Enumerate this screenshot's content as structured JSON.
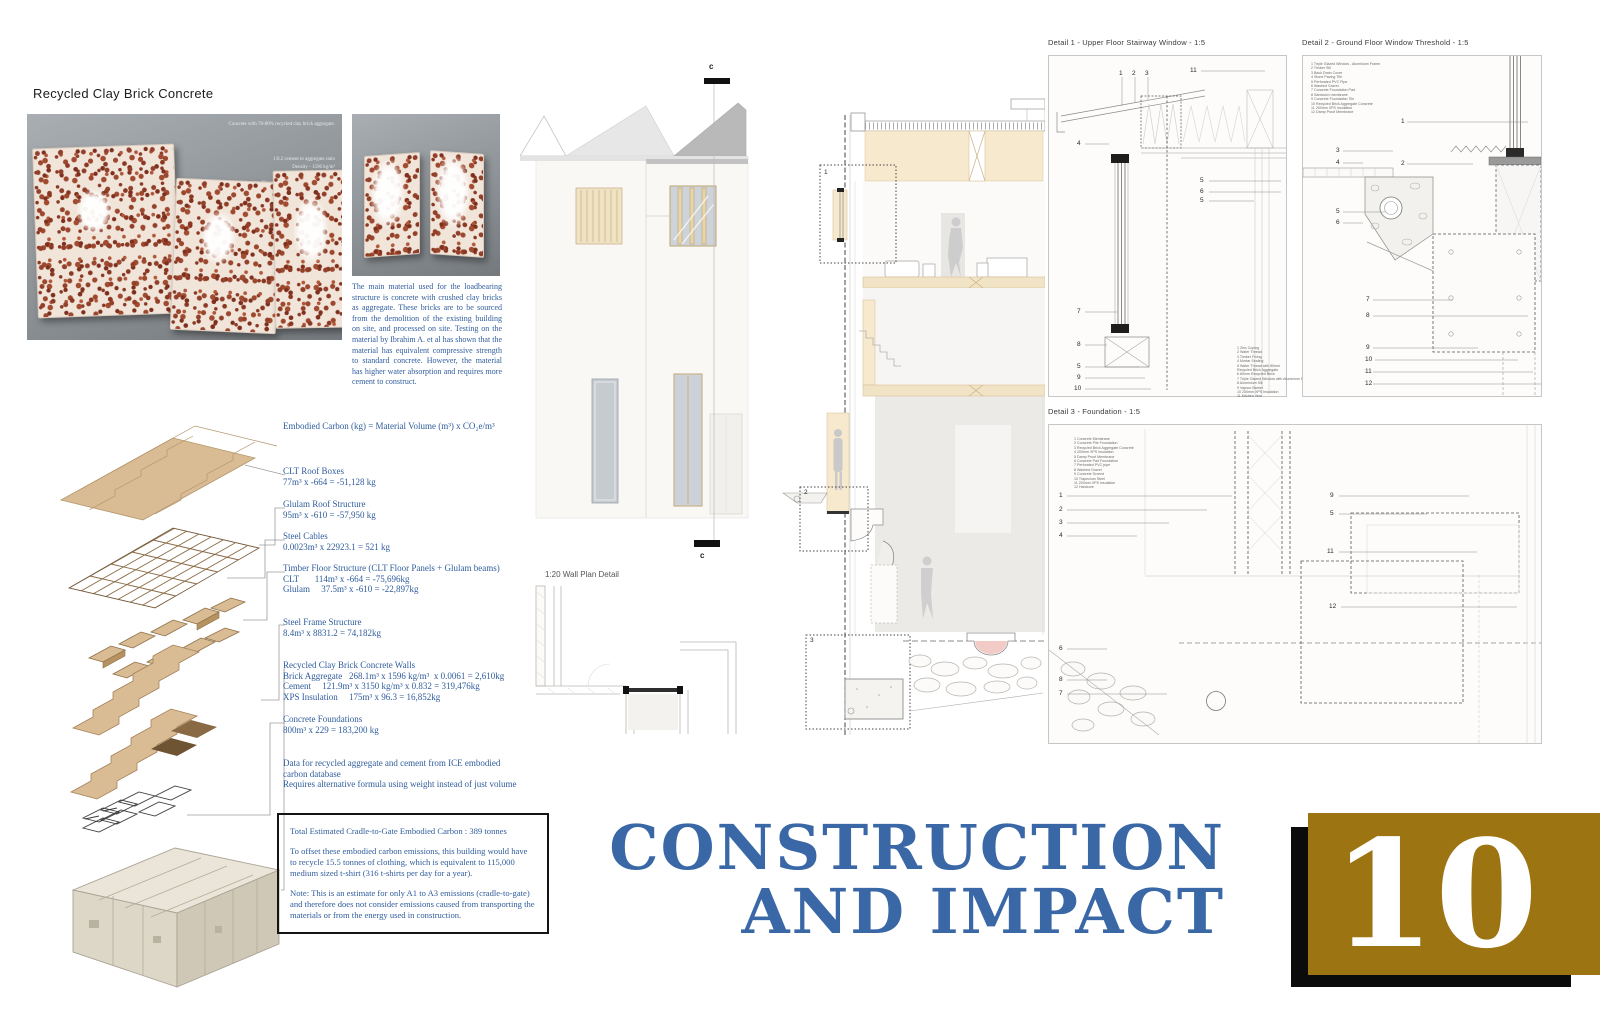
{
  "material_panel": {
    "title": "Recycled Clay Brick Concrete",
    "photo_caption": "Concrete with 70-80% recycled clay brick aggregate.",
    "photo_specs": [
      "1:0.2 cement to aggregate ratio",
      "Density - 1596 kg/m³",
      "Specific Heat - 1337 J/kgK",
      "Thermal Conductivity - 0.775W/mK"
    ],
    "description": "The main material used for the loadbearing structure is concrete with crushed clay bricks as aggregate. These bricks are to be sourced from the demolition of the existing building on site, and processed on site. Testing on the material by Ibrahim A. et al has shown that the material has equivalent compressive strength to standard concrete. However, the material has higher water absorption and requires more cement to construct."
  },
  "embodied_carbon": {
    "formula": "Embodied Carbon (kg) = Material Volume (m³) x CO₂e/m³",
    "items": [
      {
        "label": "CLT Roof Boxes",
        "line1": "77m³ x -664 = -51,128 kg",
        "line2": "",
        "line3": ""
      },
      {
        "label": "Glulam Roof Structure",
        "line1": "95m³ x -610 = -57,950 kg",
        "line2": "",
        "line3": ""
      },
      {
        "label": "Steel Cables",
        "line1": "0.0023m³ x 22923.1 = 521 kg",
        "line2": "",
        "line3": ""
      },
      {
        "label": "Timber Floor Structure (CLT Floor Panels + Glulam beams)",
        "line1": "CLT       114m³ x -664 = -75,696kg",
        "line2": "Glulam     37.5m³ x -610 = -22,897kg",
        "line3": ""
      },
      {
        "label": "Steel Frame Structure",
        "line1": "8.4m³ x 8831.2 = 74,182kg",
        "line2": "",
        "line3": ""
      },
      {
        "label": "Recycled Clay Brick Concrete Walls",
        "line1": "Brick Aggregate   268.1m³ x 1596 kg/m³  x 0.0061 = 2,610kg",
        "line2": "Cement     121.9m³ x 3150 kg/m³ x 0.832 = 319,476kg",
        "line3": "XPS Insulation     175m³ x 96.3 = 16,852kg"
      },
      {
        "label": "Concrete Foundations",
        "line1": "800m³ x 229 = 183,200 kg",
        "line2": "",
        "line3": ""
      }
    ],
    "data_note_1": "Data for recycled aggregate and cement from ICE embodied",
    "data_note_2": "carbon database",
    "data_note_3": "Requires alternative formula using weight instead of just volume",
    "summary_box": {
      "total": "Total Estimated Cradle-to-Gate Embodied Carbon : 389 tonnes",
      "offset": "To offset these embodied carbon emissions, this building would have to recycle 15.5 tonnes of clothing, which is equivalent to 115,000 medium sized t-shirt (316 t-shirts per day for a year).",
      "note": "Note: This is an estimate for only A1 to A3 emissions (cradle-to-gate) and therefore does not consider emissions caused from transporting the materials or from the energy used in construction."
    }
  },
  "drawings": {
    "wall_plan_label": "1:20 Wall Plan Detail",
    "section_marker": "c",
    "section_callouts": [
      "1",
      "2",
      "3"
    ]
  },
  "details": {
    "d1": {
      "title": "Detail 1 - Upper Floor Stairway Window - 1:5",
      "callouts": [
        "1",
        "2",
        "3",
        "11",
        "4",
        "5",
        "6",
        "5",
        "7",
        "8",
        "5",
        "9",
        "10"
      ],
      "legend": [
        "1  Zinc Coping",
        "2  Water Thread",
        "3  Timber Fixing",
        "4  Mortar Sealing",
        "5  Water Thread with 80mm",
        "    Recycled Brick Aggregate",
        "6  80mm Recycled Brick",
        "7  Triple Glazed Window with Aluminium Frame",
        "8  Aluminium Sill",
        "9  Vapour Barrier",
        "10 200mm XPS Insulation",
        "11 Kitchen Vent"
      ]
    },
    "d2": {
      "title": "Detail 2  - Ground Floor Window Threshold - 1:5",
      "callouts": [
        "1",
        "3",
        "4",
        "2",
        "5",
        "6",
        "7",
        "8",
        "9",
        "10",
        "11",
        "12"
      ],
      "legend": [
        "1  Triple Glazed Window - Aluminium Frame",
        "2  Timber Sill",
        "3  Back Drain Cover",
        "4  Stone Paving Tile",
        "5  Perforated PVC Pipe",
        "6  Washed Gravel",
        "7  Concrete Foundation Pad",
        "8  Sandwich membrane",
        "9  Concrete Foundation Tile",
        "10 Recycled Brick Aggregate Concrete",
        "11 200mm XPS Insulation",
        "12 Damp Proof Membrane"
      ]
    },
    "d3": {
      "title": "Detail 3  - Foundation - 1:5",
      "callouts": [
        "1",
        "2",
        "3",
        "4",
        "6",
        "8",
        "7",
        "9",
        "5",
        "11",
        "12"
      ],
      "legend": [
        "1  Concrete Membrane",
        "2  Concrete Pile Foundation",
        "3  Recycled Brick Aggregate Concrete",
        "4  200mm XPS Insulation",
        "5  Damp Proof Membrane",
        "6  Concrete Pad Foundation",
        "7  Perforated PVC pipe",
        "8  Washed Gravel",
        "9  Concrete Screed",
        "10 Trapezium Steel",
        "11 200mm XPS Insulation",
        "12 Hardcore"
      ]
    }
  },
  "footer": {
    "title_line1": "CONSTRUCTION",
    "title_line2": "AND IMPACT",
    "page_number": "10"
  }
}
